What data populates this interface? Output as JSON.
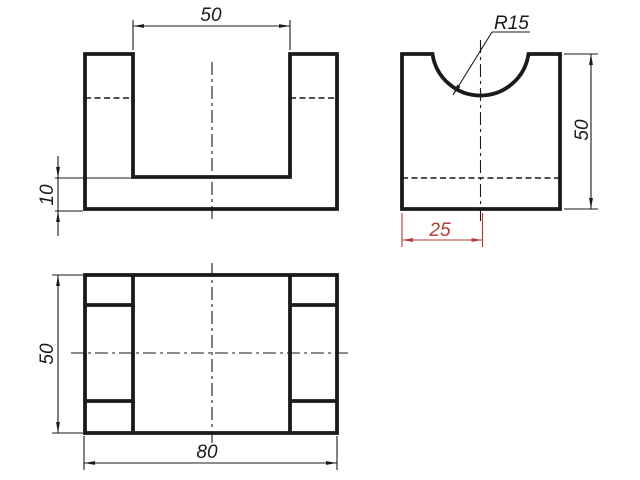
{
  "colors": {
    "paper": "#ffffff",
    "ink": "#1a1a1a",
    "accent": "#b23b32"
  },
  "views": {
    "front": {
      "dims": {
        "slot_width": "50",
        "base_thickness": "10"
      }
    },
    "side": {
      "dims": {
        "notch_radius": "R15",
        "height": "50",
        "notch_center_offset": "25"
      }
    },
    "plan": {
      "dims": {
        "depth": "50",
        "width": "80"
      }
    }
  }
}
